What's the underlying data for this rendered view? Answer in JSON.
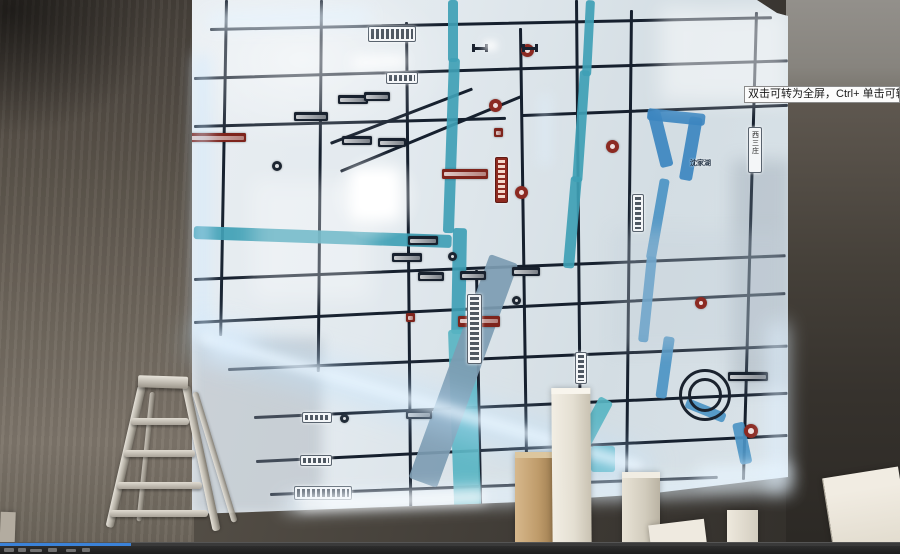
{
  "player": {
    "tooltip_text": "双击可转为全屏，Ctrl+ 单击可转为",
    "progress_pct": 14.5
  },
  "palette": {
    "accent_progress": "#3b82d8",
    "led_glow": "#bfe3ff",
    "river": "#3f9fb5",
    "road": "#16202e",
    "map_base": "#dfe7ec",
    "wall": "#4a443e",
    "lake": "#3c86c0"
  },
  "map": {
    "labels": [
      {
        "x": 498,
        "y": 158,
        "t": "沈家湖",
        "s": 7
      }
    ],
    "roads": [
      {
        "x": 18,
        "y": 28,
        "w": 562,
        "r": -1.2
      },
      {
        "x": 2,
        "y": 77,
        "w": 594,
        "r": -1.7
      },
      {
        "x": 2,
        "y": 125,
        "w": 312,
        "r": -1.5
      },
      {
        "x": 330,
        "y": 114,
        "w": 266,
        "r": -2.2
      },
      {
        "x": 2,
        "y": 278,
        "w": 592,
        "r": -2.3
      },
      {
        "x": 2,
        "y": 321,
        "w": 592,
        "r": -2.8
      },
      {
        "x": 36,
        "y": 368,
        "w": 560,
        "r": -2.4
      },
      {
        "x": 62,
        "y": 416,
        "w": 534,
        "r": -2.6
      },
      {
        "x": 64,
        "y": 460,
        "w": 532,
        "r": -2.8
      },
      {
        "x": 78,
        "y": 493,
        "w": 448,
        "r": -2.2
      },
      {
        "x": 33,
        "y": 0,
        "w": 2.5,
        "h": 336,
        "r": 1
      },
      {
        "x": 128,
        "y": 0,
        "w": 2.5,
        "h": 372,
        "r": 0.5
      },
      {
        "x": 213,
        "y": 22,
        "w": 2.5,
        "h": 486,
        "r": -0.5
      },
      {
        "x": 283,
        "y": 270,
        "w": 2.5,
        "h": 242,
        "r": -1
      },
      {
        "x": 327,
        "y": 28,
        "w": 2.5,
        "h": 480,
        "r": -0.8
      },
      {
        "x": 383,
        "y": 0,
        "w": 3,
        "h": 506,
        "r": -0.5
      },
      {
        "x": 438,
        "y": 10,
        "w": 2.5,
        "h": 490,
        "r": 0.6
      },
      {
        "x": 563,
        "y": 12,
        "w": 2.5,
        "h": 468,
        "r": 1.6
      },
      {
        "x": 148,
        "y": 170,
        "w": 196,
        "r": -22.5
      },
      {
        "x": 138,
        "y": 142,
        "w": 152,
        "r": -21
      }
    ],
    "rivers": [
      {
        "x": 256,
        "y": 0,
        "w": 10,
        "h": 62,
        "r": 0
      },
      {
        "x": 257,
        "y": 58,
        "w": 11,
        "h": 175,
        "r": 2
      },
      {
        "x": 261,
        "y": 228,
        "w": 14,
        "h": 106,
        "r": 1
      },
      {
        "x": 256,
        "y": 330,
        "w": 27,
        "h": 184,
        "r": -2,
        "c": "#58b4c2"
      },
      {
        "x": 2,
        "y": 226,
        "w": 258,
        "h": 13,
        "r": 2
      },
      {
        "x": 394,
        "y": 0,
        "w": 9,
        "h": 76,
        "r": 3
      },
      {
        "x": 388,
        "y": 70,
        "w": 10,
        "h": 112,
        "r": 4
      },
      {
        "x": 379,
        "y": 176,
        "w": 11,
        "h": 92,
        "r": 5
      },
      {
        "x": 298,
        "y": 254,
        "w": 30,
        "h": 238,
        "r": 20,
        "c": "#7d9cb2"
      },
      {
        "x": 455,
        "y": 112,
        "w": 13,
        "h": 58,
        "r": -14,
        "c": "#3c86c0"
      },
      {
        "x": 456,
        "y": 108,
        "w": 58,
        "h": 12,
        "r": 6,
        "c": "#3c86c0"
      },
      {
        "x": 498,
        "y": 116,
        "w": 13,
        "h": 64,
        "r": 10,
        "c": "#3c86c0"
      },
      {
        "x": 468,
        "y": 178,
        "w": 10,
        "h": 82,
        "r": 10,
        "c": "#4c94c4"
      },
      {
        "x": 455,
        "y": 256,
        "w": 10,
        "h": 86,
        "r": 6,
        "c": "#4c94c4"
      },
      {
        "x": 472,
        "y": 336,
        "w": 11,
        "h": 62,
        "r": 8,
        "c": "#4c94c4"
      },
      {
        "x": 496,
        "y": 398,
        "w": 42,
        "h": 10,
        "r": 22,
        "c": "#4c94c4"
      },
      {
        "x": 408,
        "y": 396,
        "w": 15,
        "h": 52,
        "r": 28,
        "c": "#58b4c2"
      },
      {
        "x": 399,
        "y": 446,
        "w": 24,
        "h": 26,
        "r": 0,
        "c": "#58b4c2"
      },
      {
        "x": 540,
        "y": 424,
        "w": 12,
        "h": 42,
        "r": -12,
        "c": "#4c94c4"
      }
    ],
    "chips": [
      {
        "x": 146,
        "y": 95,
        "w": 30,
        "t": "d"
      },
      {
        "x": 102,
        "y": 112,
        "w": 34,
        "t": "d"
      },
      {
        "x": 150,
        "y": 136,
        "w": 30,
        "t": "d"
      },
      {
        "x": 186,
        "y": 138,
        "w": 28,
        "t": "d"
      },
      {
        "x": 172,
        "y": 92,
        "w": 26,
        "t": "d"
      },
      {
        "x": 216,
        "y": 236,
        "w": 30,
        "t": "d"
      },
      {
        "x": 200,
        "y": 253,
        "w": 30,
        "t": "d"
      },
      {
        "x": 226,
        "y": 272,
        "w": 26,
        "t": "d"
      },
      {
        "x": 268,
        "y": 271,
        "w": 26,
        "t": "d"
      },
      {
        "x": 320,
        "y": 267,
        "w": 28,
        "t": "d"
      },
      {
        "x": 536,
        "y": 372,
        "w": 40,
        "t": "d"
      },
      {
        "x": 214,
        "y": 410,
        "w": 26,
        "t": "d"
      },
      {
        "x": 250,
        "y": 169,
        "w": 46,
        "h": 10,
        "t": "r"
      },
      {
        "x": 266,
        "y": 316,
        "w": 42,
        "h": 11,
        "t": "r"
      },
      {
        "x": -4,
        "y": 133,
        "w": 58,
        "h": 9,
        "t": "r"
      },
      {
        "x": 302,
        "y": 128,
        "w": 9,
        "h": 9,
        "t": "r"
      },
      {
        "x": 214,
        "y": 313,
        "w": 9,
        "h": 9,
        "t": "r"
      }
    ],
    "circles": [
      {
        "x": 297,
        "y": 99,
        "d": 13
      },
      {
        "x": 329,
        "y": 44,
        "d": 13
      },
      {
        "x": 414,
        "y": 140,
        "d": 13
      },
      {
        "x": 323,
        "y": 186,
        "d": 13
      },
      {
        "x": 552,
        "y": 424,
        "d": 14
      },
      {
        "x": 503,
        "y": 297,
        "d": 12
      },
      {
        "x": 80,
        "y": 161,
        "d": 10,
        "t": "d"
      },
      {
        "x": 256,
        "y": 252,
        "d": 9,
        "t": "d"
      },
      {
        "x": 320,
        "y": 296,
        "d": 9,
        "t": "d"
      },
      {
        "x": 148,
        "y": 414,
        "d": 9,
        "t": "d"
      }
    ],
    "plaques": [
      {
        "x": 176,
        "y": 26,
        "w": 46,
        "h": 14
      },
      {
        "x": 194,
        "y": 72,
        "w": 30,
        "h": 10
      },
      {
        "x": 110,
        "y": 412,
        "w": 28,
        "h": 9
      },
      {
        "x": 108,
        "y": 455,
        "w": 30,
        "h": 9
      },
      {
        "x": 102,
        "y": 486,
        "w": 56,
        "h": 12
      },
      {
        "x": 556,
        "y": 127,
        "w": 12,
        "h": 44,
        "v": true,
        "label": "西三庄"
      },
      {
        "x": 275,
        "y": 294,
        "w": 13,
        "h": 68,
        "v": true
      },
      {
        "x": 440,
        "y": 194,
        "w": 10,
        "h": 36,
        "v": true
      },
      {
        "x": 383,
        "y": 352,
        "w": 10,
        "h": 30,
        "v": true
      },
      {
        "x": 303,
        "y": 157,
        "w": 11,
        "h": 44,
        "v": true,
        "s": "red"
      }
    ],
    "rings": [
      {
        "x": 487,
        "y": 369,
        "d": 46
      },
      {
        "x": 496,
        "y": 378,
        "d": 28
      }
    ],
    "bridges": [
      {
        "x": 280,
        "y": 44
      },
      {
        "x": 330,
        "y": 44
      }
    ],
    "shades": [
      {
        "x": -40,
        "y": -30,
        "w": 300,
        "h": 180,
        "c": "radial-gradient(closest-side,rgba(255,255,255,.55),rgba(255,255,255,0))"
      },
      {
        "x": 540,
        "y": 160,
        "w": 60,
        "h": 230,
        "c": "rgba(125,140,155,.28)",
        "b": 8
      },
      {
        "x": 0,
        "y": 338,
        "w": 130,
        "h": 176,
        "c": "rgba(148,158,166,.35)",
        "b": 6
      },
      {
        "x": 468,
        "y": 8,
        "w": 130,
        "h": 95,
        "c": "rgba(255,255,255,.5)",
        "b": 10
      },
      {
        "x": 420,
        "y": 230,
        "w": 175,
        "h": 120,
        "c": "rgba(195,208,218,.32)",
        "b": 8
      },
      {
        "x": 60,
        "y": 180,
        "w": 120,
        "h": 120,
        "c": "rgba(255,255,255,.3)",
        "b": 10
      }
    ],
    "glows": [
      {
        "x": 330,
        "y": 150,
        "w": 92,
        "h": 92,
        "c": "radial-gradient(closest-side,#ffffff,rgba(210,235,255,0))",
        "o": 0.95
      },
      {
        "x": 352,
        "y": 170,
        "w": 46,
        "h": 48,
        "c": "#ffffff",
        "b": 6
      },
      {
        "x": 359,
        "y": 177,
        "w": 30,
        "h": 32,
        "c": "#ffffff",
        "b": 2
      },
      {
        "x": 352,
        "y": 57,
        "w": 54,
        "h": 12,
        "c": "#ffffff",
        "b": 6,
        "o": 0.9,
        "r": -2
      },
      {
        "x": 208,
        "y": 14,
        "w": 162,
        "h": 13,
        "c": "#e6f4ff",
        "b": 8,
        "o": 0.85,
        "r": -1.5
      },
      {
        "x": 196,
        "y": 55,
        "w": 12,
        "h": 282,
        "c": "#cfe9ff",
        "b": 8,
        "o": 0.7
      },
      {
        "x": 203,
        "y": 333,
        "w": 458,
        "h": 9,
        "c": "#ffffff",
        "b": 5,
        "o": 0.95,
        "r": 16.5
      },
      {
        "x": 198,
        "y": 324,
        "w": 470,
        "h": 28,
        "c": "#bfe3ff",
        "b": 16,
        "o": 0.55,
        "r": 16.5
      },
      {
        "x": 285,
        "y": 497,
        "w": 505,
        "h": 13,
        "c": "#e8f5ff",
        "b": 9,
        "o": 0.9,
        "r": -2.2
      },
      {
        "x": 300,
        "y": 500,
        "w": 185,
        "h": 9,
        "c": "#ffffff",
        "b": 6,
        "o": 0.95,
        "r": -2.2
      },
      {
        "x": 770,
        "y": 323,
        "w": 16,
        "h": 168,
        "c": "#dff0ff",
        "b": 10,
        "o": 0.8
      },
      {
        "x": 484,
        "y": 41,
        "w": 13,
        "h": 9,
        "c": "#ffffff",
        "b": 4,
        "o": 0.95
      },
      {
        "x": 208,
        "y": 328,
        "w": 44,
        "h": 32,
        "c": "#dff0ff",
        "b": 12,
        "o": 0.7
      },
      {
        "x": 698,
        "y": 468,
        "w": 92,
        "h": 14,
        "c": "#e8f5ff",
        "b": 8,
        "o": 0.85,
        "r": -3
      },
      {
        "x": 540,
        "y": 95,
        "w": 10,
        "h": 70,
        "c": "#dff0ff",
        "b": 6,
        "o": 0.5
      }
    ]
  }
}
